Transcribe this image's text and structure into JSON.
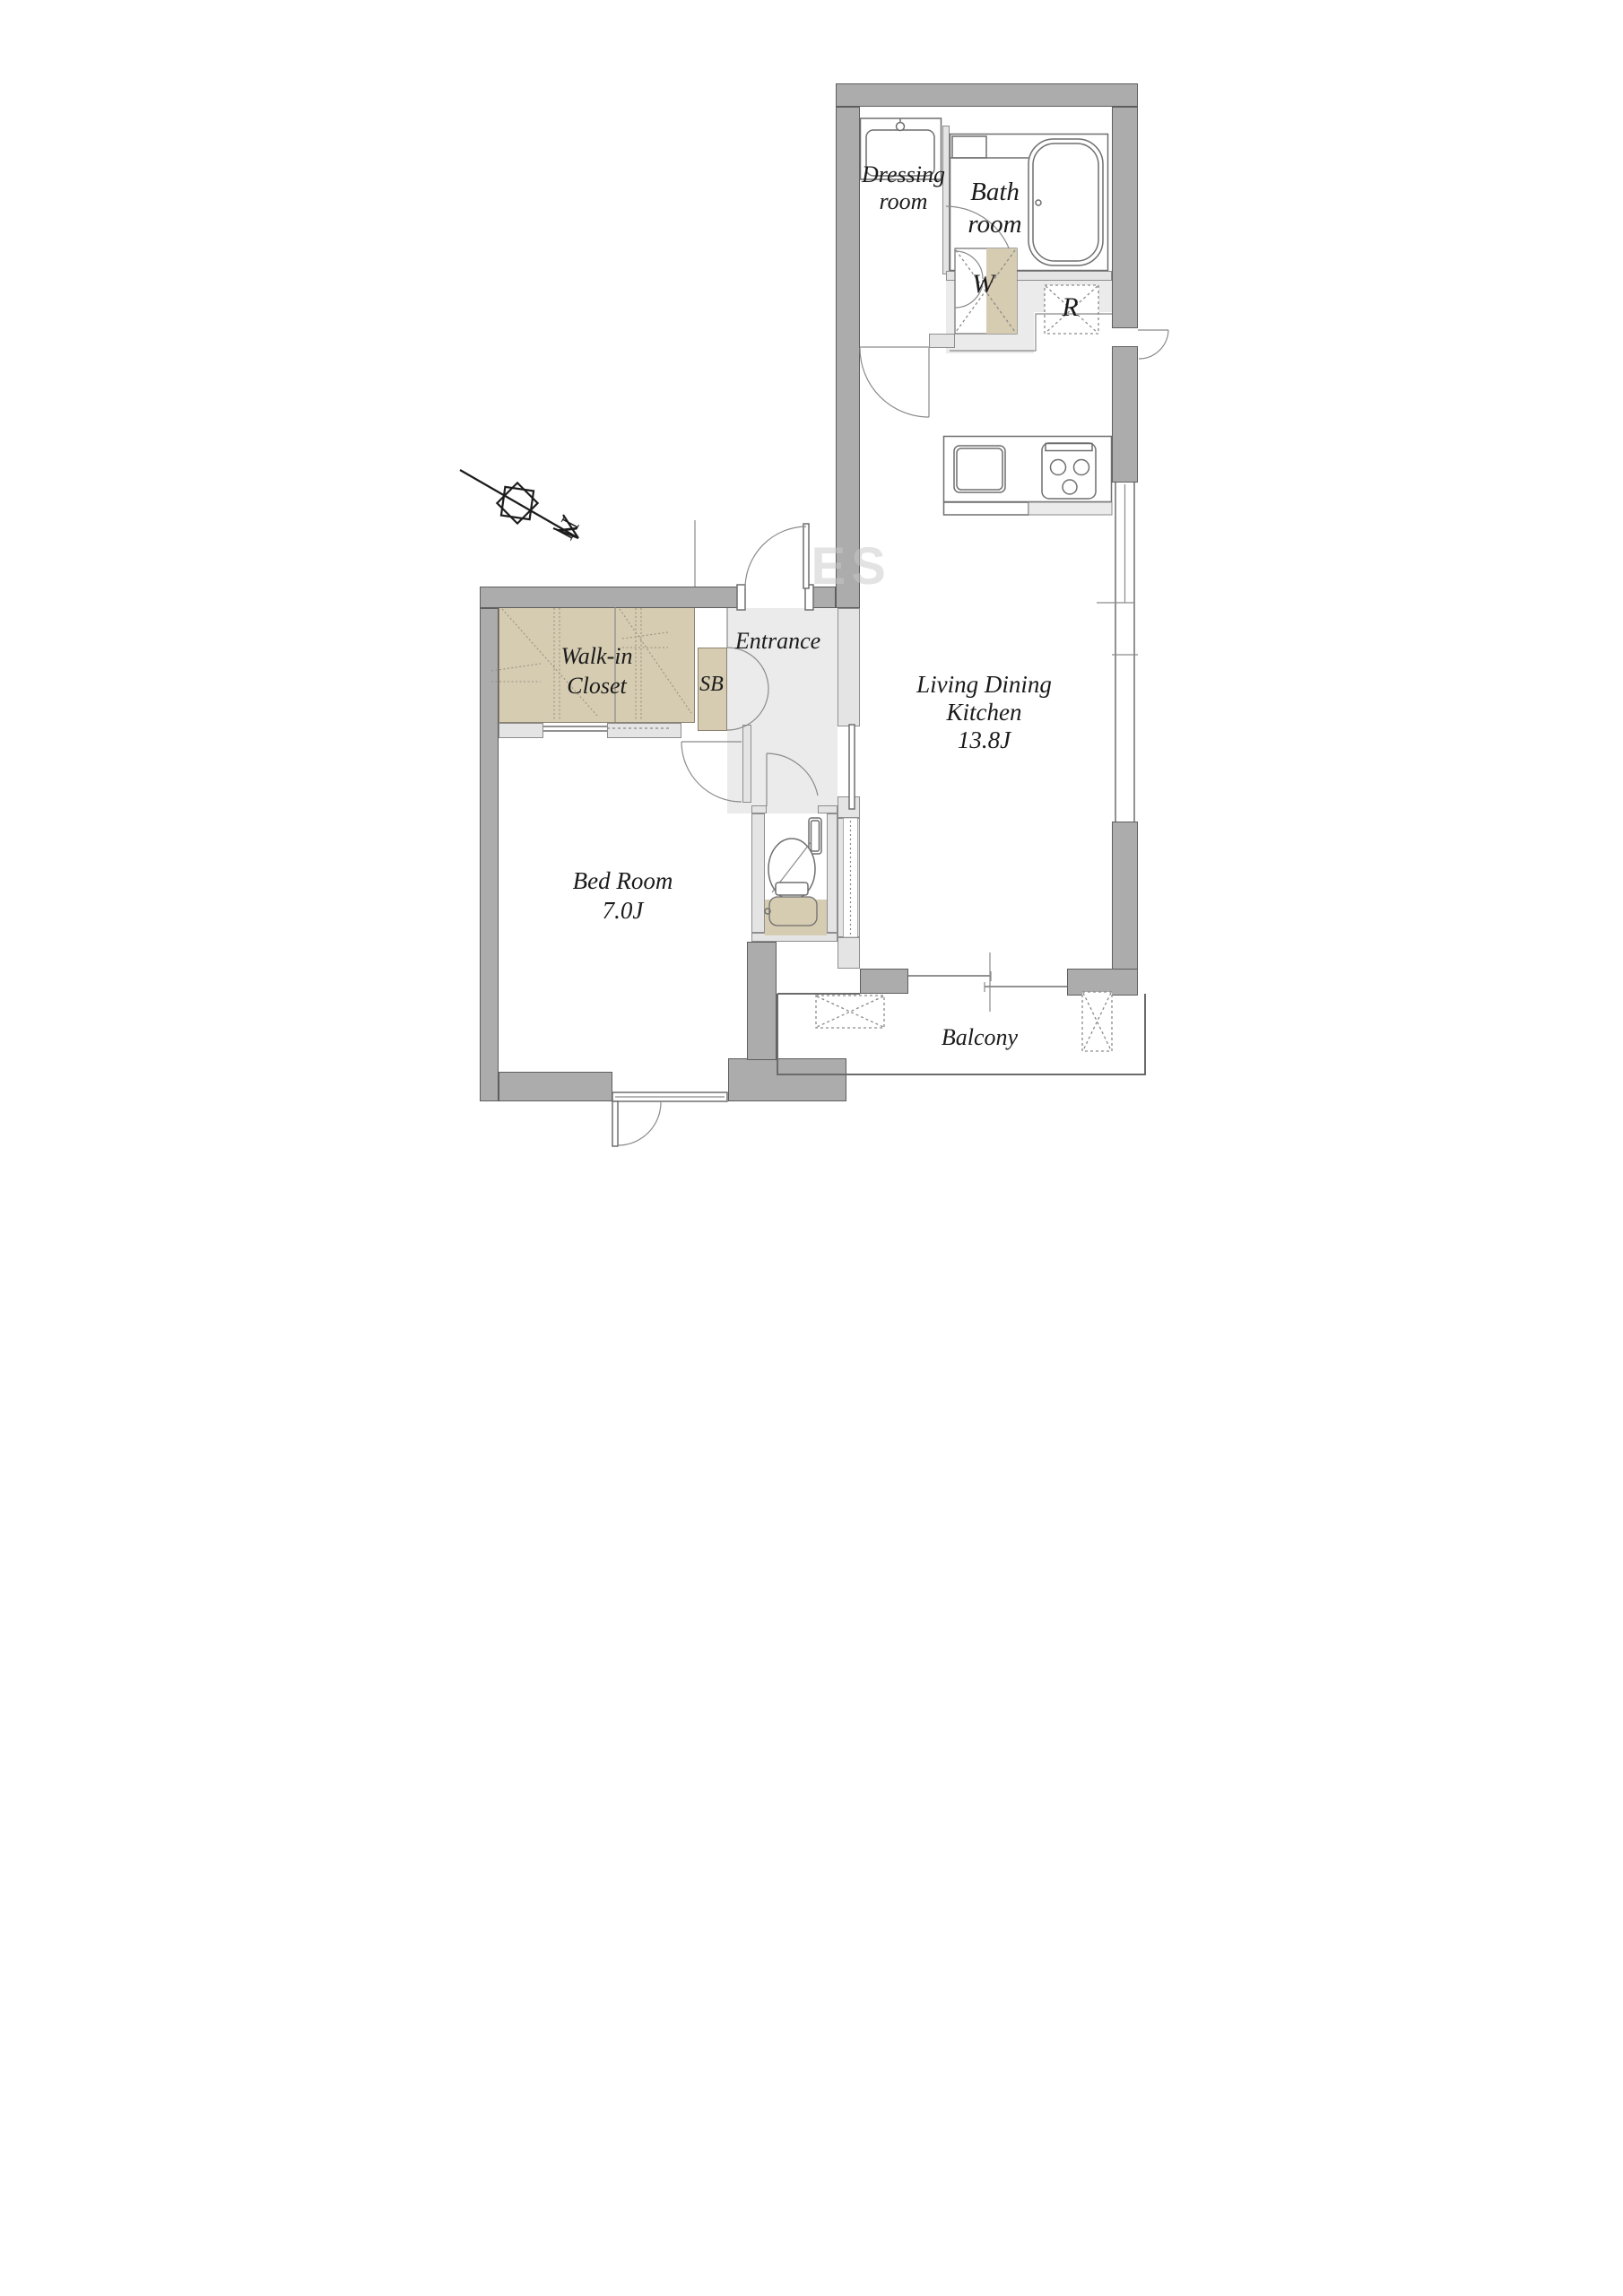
{
  "labels": {
    "bath": [
      "Bath",
      "room"
    ],
    "dressing": [
      "Dressing",
      "room"
    ],
    "washer": "W",
    "fridge": "R",
    "walk_in_closet": [
      "Walk-in",
      "Closet"
    ],
    "shoe_box": "SB",
    "entrance": "Entrance",
    "ldk": [
      "Living Dining",
      "Kitchen",
      "13.8J"
    ],
    "bedroom": [
      "Bed Room",
      "7.0J"
    ],
    "balcony": "Balcony",
    "compass_north": "N",
    "watermark": "ES"
  },
  "colors": {
    "wall": "#ACACAC",
    "wall_outline": "#5E5E5E",
    "partition": "#E4E4E4",
    "floor_light": "#EBEBEB",
    "closet_tan": "#D6CCB2",
    "line": "#6F6F6F",
    "text": "#1B1B1B"
  }
}
